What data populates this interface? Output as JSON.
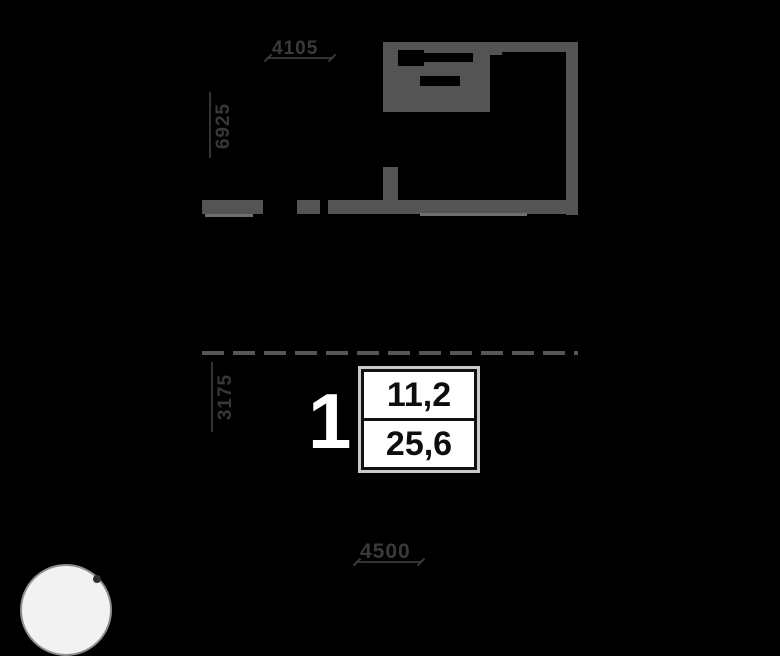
{
  "canvas": {
    "width": 780,
    "height": 580,
    "background": "#000000"
  },
  "floor_plan": {
    "dimensions": {
      "top": "4105",
      "left_upper": "6925",
      "left_lower": "3175",
      "bottom": "4500"
    },
    "unit": {
      "number": "1",
      "living_area": "11,2",
      "total_area": "25,6"
    },
    "colors": {
      "wall": "#545454",
      "dimension_text": "#3a3a3a",
      "dashed_line": "#565656",
      "unit_number_text": "#ffffff",
      "area_text": "#0e0e0e",
      "area_box_background": "#ffffff",
      "area_box_outer_border": "#c9c9c9",
      "area_box_inner_border": "#111111"
    }
  },
  "watermark": {
    "shape": "circle",
    "fill": "#f2f2f2",
    "border": "#8f8f8f"
  }
}
